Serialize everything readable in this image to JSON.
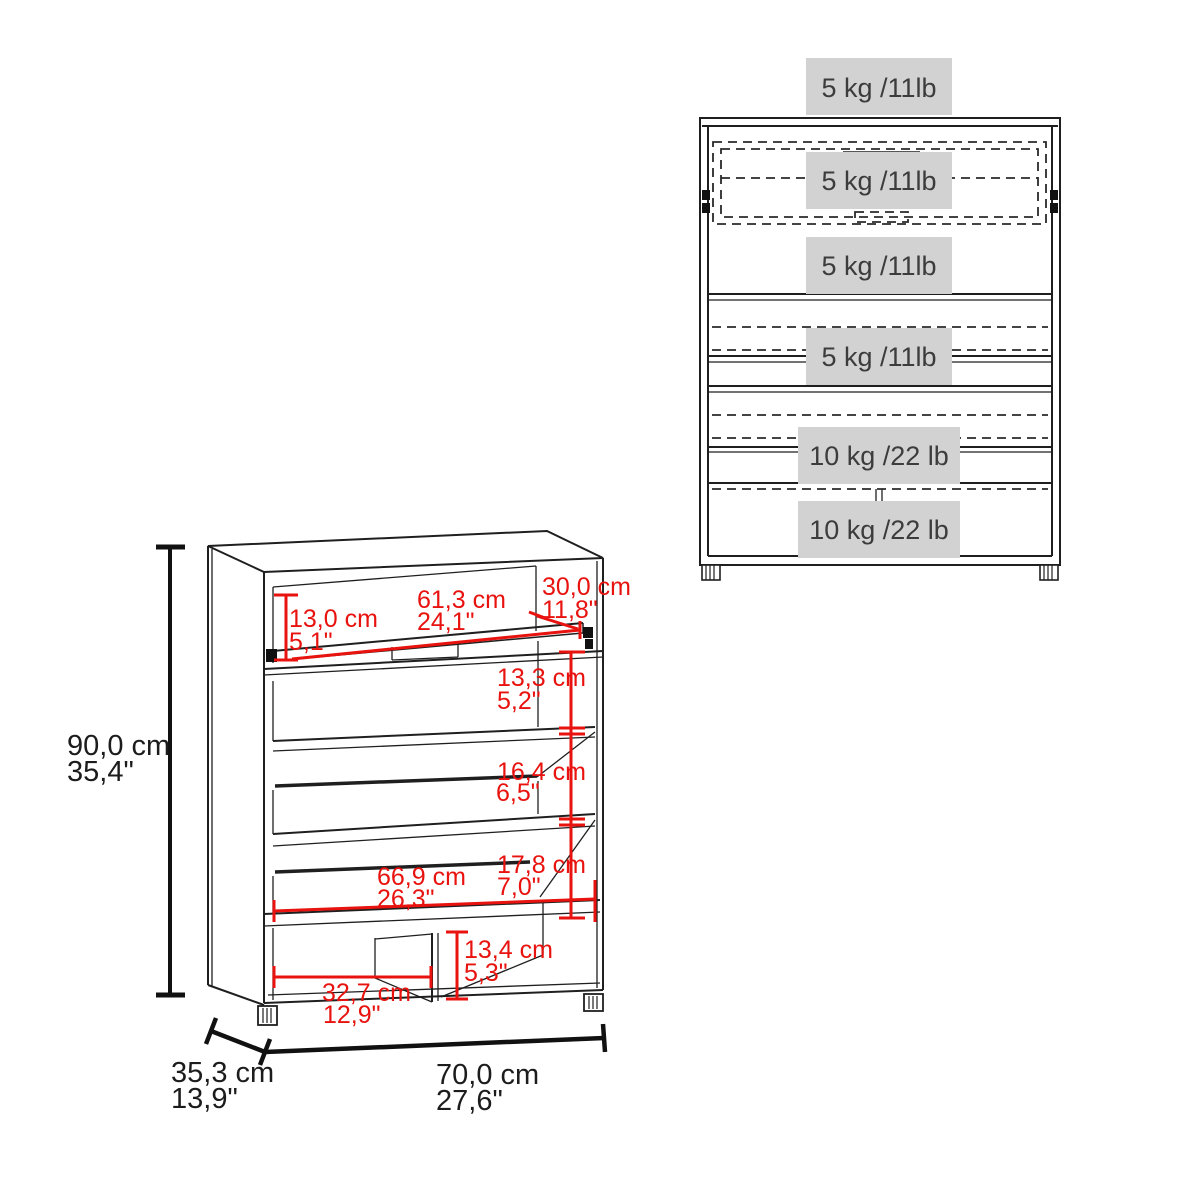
{
  "page": {
    "title": "Shoe cabinet dimension diagram",
    "background": "#ffffff"
  },
  "perspective_view": {
    "overall_height": {
      "cm": "90,0 cm",
      "in": "35,4\""
    },
    "overall_width": {
      "cm": "70,0 cm",
      "in": "27,6\""
    },
    "overall_depth": {
      "cm": "35,3 cm",
      "in": "13,9\""
    },
    "opening_height": {
      "cm": "13,0 cm",
      "in": "5,1\""
    },
    "opening_width": {
      "cm": "61,3 cm",
      "in": "24,1\""
    },
    "opening_depth": {
      "cm": "30,0 cm",
      "in": "11,8\""
    },
    "gap_top": {
      "cm": "13,3 cm",
      "in": "5,2\""
    },
    "gap_middle": {
      "cm": "16,4 cm",
      "in": "6,5\""
    },
    "gap_lower": {
      "cm": "17,8 cm",
      "in": "7,0\""
    },
    "shelf_width": {
      "cm": "66,9 cm",
      "in": "26,3\""
    },
    "cubby_width": {
      "cm": "32,7 cm",
      "in": "12,9\""
    },
    "cubby_height": {
      "cm": "13,4 cm",
      "in": "5,3\""
    }
  },
  "front_view": {
    "capacity_labels": [
      "5 kg /11lb",
      "5 kg /11lb",
      "5 kg /11lb",
      "5 kg /11lb",
      "10 kg /22 lb",
      "10 kg /22 lb"
    ]
  },
  "colors": {
    "dimension_red": "#e8120e",
    "line_black": "#1f1f1f",
    "capacity_band_gray": "#d2d2d2",
    "capacity_text": "#3c3c3c"
  }
}
